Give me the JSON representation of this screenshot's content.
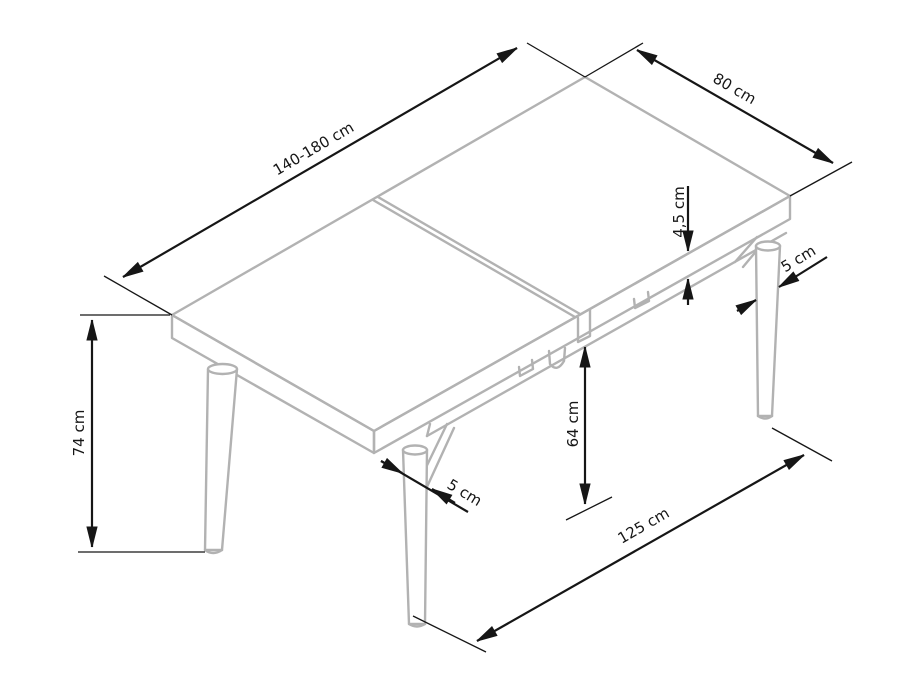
{
  "page": {
    "background": "#ffffff"
  },
  "diagram": {
    "type": "isometric furniture dimension drawing",
    "subject": "extendable rectangular dining table with round tapered legs",
    "colors": {
      "furniture_outline": "#b2b2b2",
      "dimension_lines": "#161616",
      "background": "#ffffff"
    },
    "labels": {
      "table_length": "140-180 cm",
      "table_width": "80 cm",
      "top_thickness": "4,5 cm",
      "back_leg_diameter": "5 cm",
      "table_height": "74 cm",
      "apron_clearance": "64 cm",
      "front_leg_diameter": "5 cm",
      "leg_spacing": "125 cm"
    }
  }
}
